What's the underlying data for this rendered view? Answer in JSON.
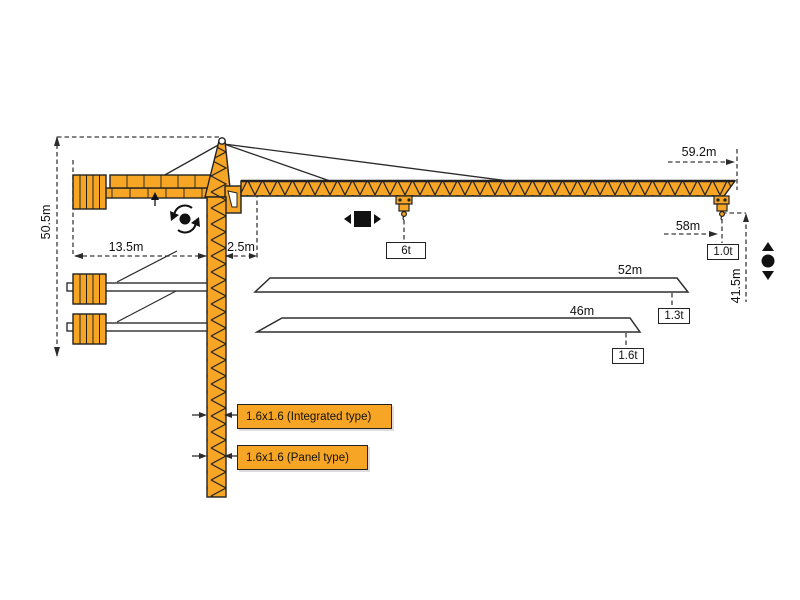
{
  "diagram_title": "tower-crane-dimension-diagram",
  "colors": {
    "crane_orange": "#F6A524",
    "line": "#2b2b2b",
    "bar_white": "#ffffff"
  },
  "dims": {
    "height_total": "50.5m",
    "counterjib_length": "13.5m",
    "rear_offset": "2.5m",
    "radius_max": "59.2m",
    "radius_hook": "58m",
    "height_under_hook": "41.5m",
    "jib_option_52": "52m",
    "jib_option_46": "46m"
  },
  "loads": {
    "mid_span": "6t",
    "tip_59m": "1.0t",
    "tip_52m": "1.3t",
    "tip_46m": "1.6t"
  },
  "mast_sections": {
    "integrated": "1.6x1.6 (Integrated type)",
    "panel": "1.6x1.6 (Panel type)"
  }
}
